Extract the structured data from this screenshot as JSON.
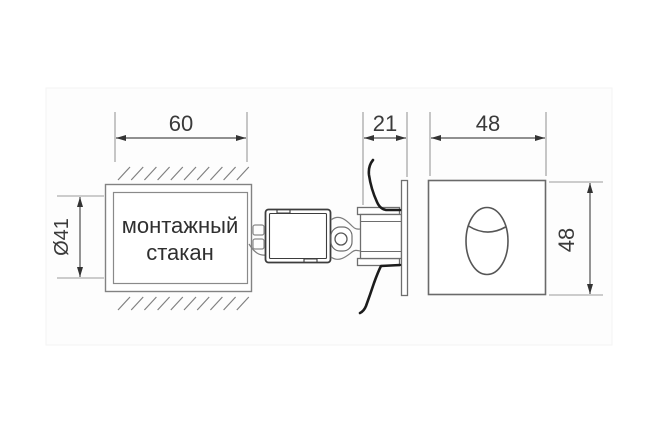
{
  "drawing": {
    "dimensions": {
      "cup_width": "60",
      "cup_diameter": "Ø41",
      "fixture_depth": "21",
      "face_width": "48",
      "face_height": "48"
    },
    "labels": {
      "cup_line1": "монтажный",
      "cup_line2": "стакан"
    },
    "colors": {
      "background": "#ffffff",
      "outline_gray": "#828282",
      "dimension_line": "#4f4f4f",
      "dimension_text": "#3a3a3a",
      "label_text": "#2f2f2f",
      "driver_box_outline": "#3d3d3d",
      "spring_clip": "#1c1c1c"
    }
  }
}
